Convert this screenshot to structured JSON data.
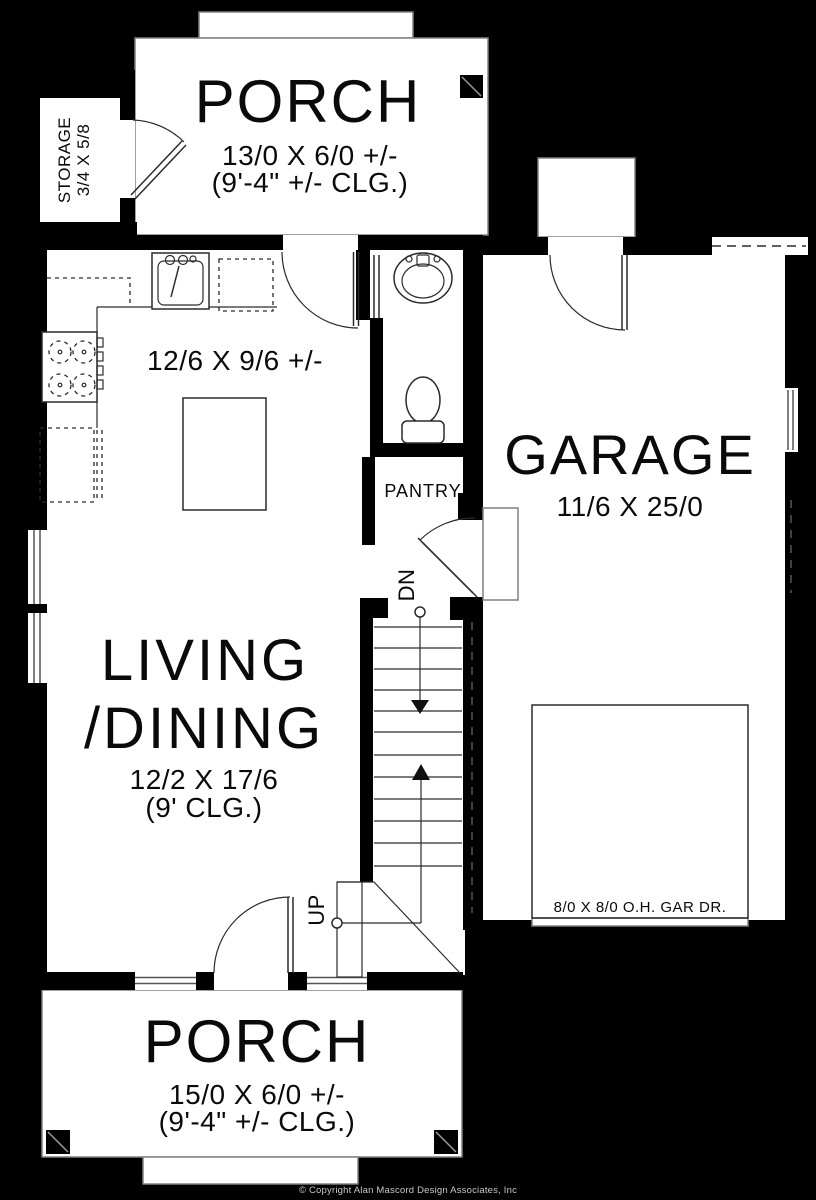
{
  "colors": {
    "background": "#000000",
    "floor": "#ffffff",
    "wall": "#000000",
    "line": "#2b2b2b",
    "edge": "#808080",
    "copyright": "#c8c8c8"
  },
  "rooms": {
    "porch_top": {
      "name": "PORCH",
      "dim": "13/0 X 6/0 +/-",
      "clg": "(9'-4\" +/- CLG.)"
    },
    "storage": {
      "line1": "STORAGE",
      "line2": "3/4 X 5/8"
    },
    "kitchen": {
      "dim": "12/6 X 9/6 +/-"
    },
    "garage": {
      "name": "GARAGE",
      "dim": "11/6 X 25/0",
      "door_label": "8/0 X 8/0 O.H. GAR DR."
    },
    "pantry": {
      "name": "PANTRY"
    },
    "living_dining": {
      "name_line1": "LIVING",
      "name_line2": "/DINING",
      "dim": "12/2 X 17/6",
      "clg": "(9' CLG.)"
    },
    "porch_bottom": {
      "name": "PORCH",
      "dim": "15/0 X 6/0 +/-",
      "clg": "(9'-4\" +/- CLG.)"
    }
  },
  "stairs": {
    "down_label": "DN",
    "up_label": "UP"
  },
  "footer": {
    "copyright": "© Copyright Alan Mascord Design Associates, Inc"
  }
}
